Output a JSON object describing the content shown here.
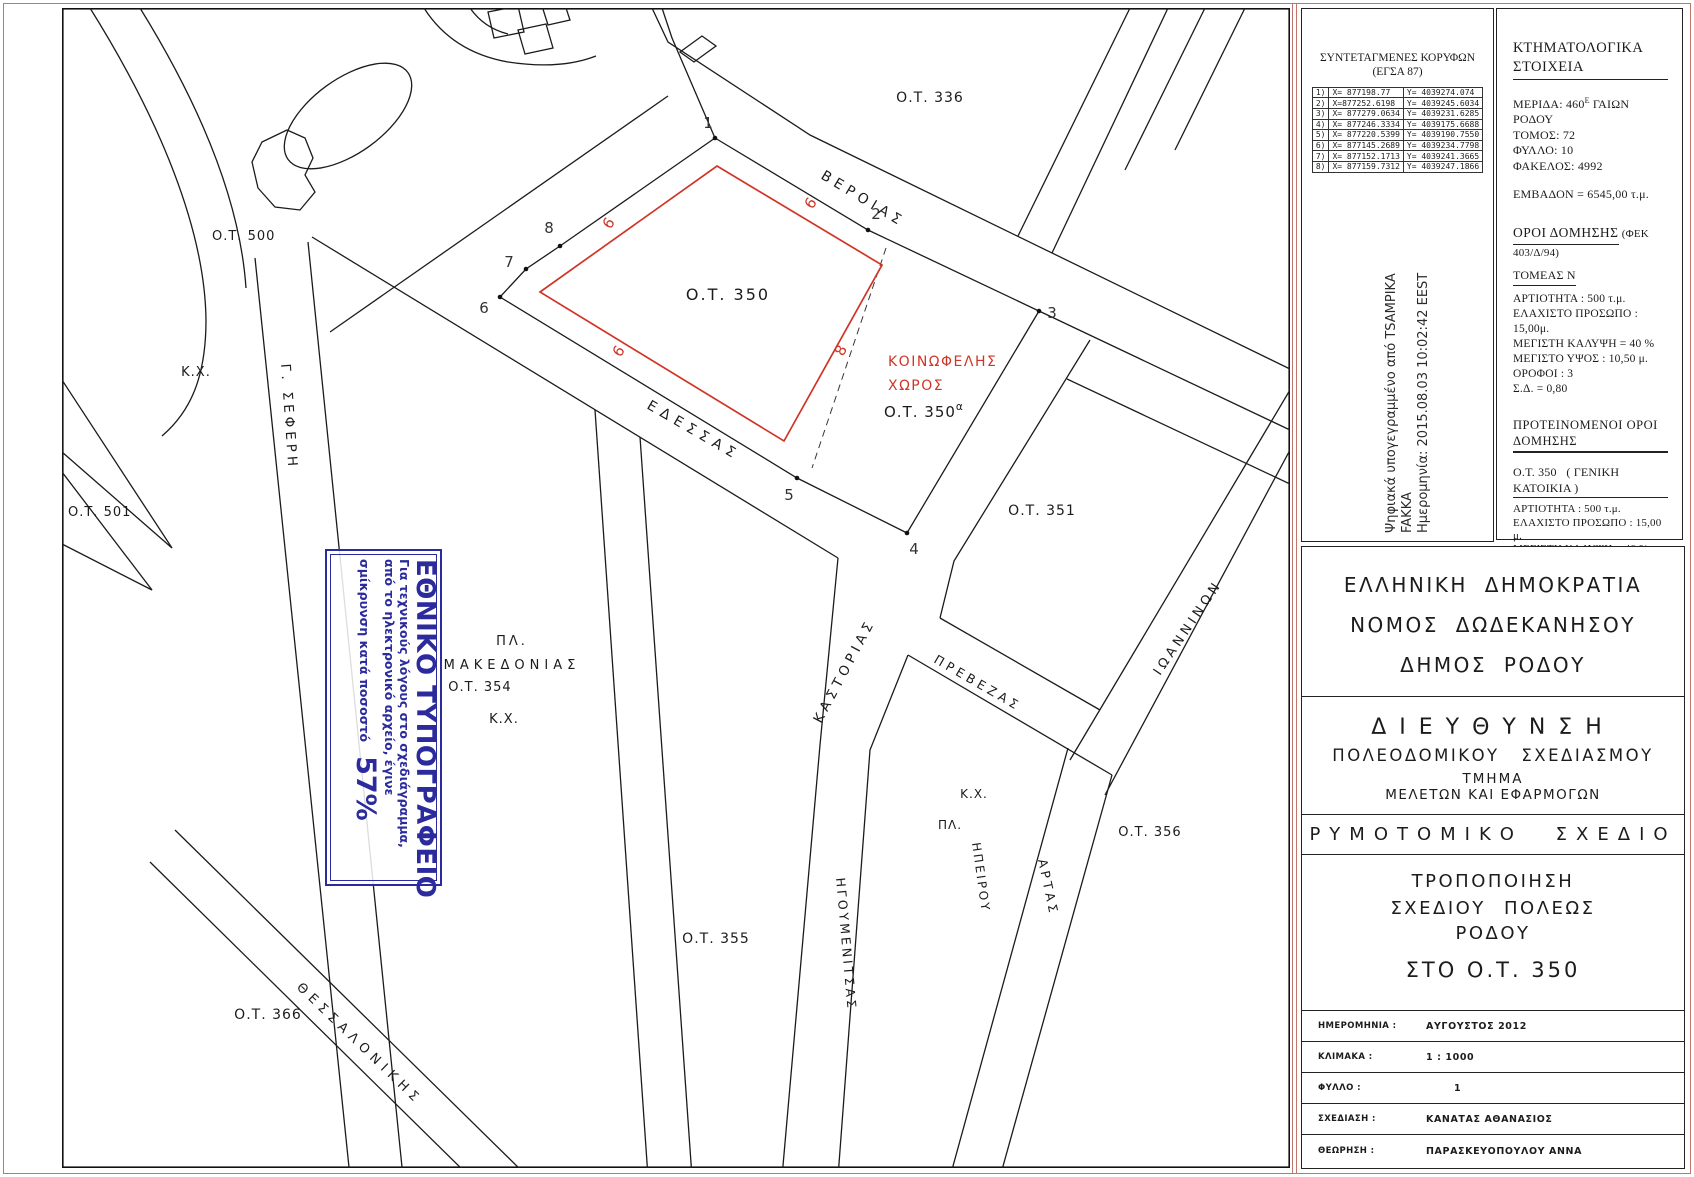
{
  "colors": {
    "accent_red": "#cf3526",
    "stamp_blue": "#2b2b9e",
    "frame_pink": "#c1766b",
    "line_black": "#1b1b1b"
  },
  "map": {
    "blocks": {
      "b336": "Ο.Τ. 336",
      "b350": "Ο.Τ.  350",
      "b350a_pre": "Ο.Τ.  350",
      "b350a_sup": "α",
      "b351": "Ο.Τ. 351",
      "b354": "Ο.Τ. 354",
      "b355": "Ο.Τ. 355",
      "b356": "Ο.Τ. 356",
      "b366": "Ο.Τ. 366",
      "b500": "Ο.Τ. 500",
      "b501": "Ο.Τ. 501"
    },
    "streets": {
      "verias": "ΒΕΡΟΙΑΣ",
      "edessas": "ΕΔΕΣΣΑΣ",
      "kastorias": "ΚΑΣΤΟΡΙΑΣ",
      "prevezas": "ΠΡΕΒΕΖΑΣ",
      "igoumenitsas": "ΗΓΟΥΜΕΝΙΤΣΑΣ",
      "ioanninon": "ΙΩΑΝΝΙΝΩΝ",
      "artas": "ΑΡΤΑΣ",
      "thessalonikis": "ΘΕΣΣΑΛΟΝΙΚΗΣ",
      "seferi": "Γ. ΣΕΦΕΡΗ"
    },
    "labels": {
      "kx_left": "Κ.Χ.",
      "pl_mak": "ΠΛ.",
      "makedonias": "ΜΑΚΕΔΟΝΙΑΣ",
      "kx_mak": "Κ.Χ.",
      "kx_plaza": "Κ.Χ.",
      "pl_plaza": "ΠΛ.",
      "ipeirou": "ΗΠΕΙΡΟΥ",
      "koinofelis1": "ΚΟΙΝΩΦΕΛΗΣ",
      "koinofelis2": "ΧΩΡΟΣ"
    },
    "vertices": [
      "1",
      "2",
      "3",
      "4",
      "5",
      "6",
      "7",
      "8"
    ],
    "red_dims": [
      "6",
      "6",
      "6",
      "8"
    ]
  },
  "coords_table": {
    "title1": "ΣΥΝΤΕΤΑΓΜΕΝΕΣ ΚΟΡΥΦΩΝ",
    "title2": "(ΕΓΣΑ 87)",
    "rows": [
      {
        "n": "1)",
        "x": "X= 877198.77",
        "y": "Y= 4039274.074"
      },
      {
        "n": "2)",
        "x": "X=877252.6198",
        "y": "Y= 4039245.6034"
      },
      {
        "n": "3)",
        "x": "X= 877279.0634",
        "y": "Y= 4039231.6285"
      },
      {
        "n": "4)",
        "x": "X= 877246.3334",
        "y": "Y= 4039175.6688"
      },
      {
        "n": "5)",
        "x": "X= 877220.5399",
        "y": "Y= 4039190.7550"
      },
      {
        "n": "6)",
        "x": "X= 877145.2689",
        "y": "Y= 4039234.7798"
      },
      {
        "n": "7)",
        "x": "X= 877152.1713",
        "y": "Y= 4039241.3665"
      },
      {
        "n": "8)",
        "x": "X= 877159.7312",
        "y": "Y= 4039247.1866"
      }
    ]
  },
  "signature": {
    "line1": "Ψηφιακά υπογεγραμμένο από TSAMPIKA",
    "line2": "FAKKA",
    "line3": "Ημερομηνία: 2015.08.03 10:02:42 EEST"
  },
  "cadastral": {
    "title": "ΚΤΗΜΑΤΟΛΟΓΙΚΑ ΣΤΟΙΧΕΙΑ",
    "merida_pre": "ΜΕΡΙΔΑ: 460",
    "merida_sup": "Ε",
    "merida_post": "ΓΑΙΩΝ ΡΟΔΟΥ",
    "tomos": "ΤΟΜΟΣ: 72",
    "fyllo": "ΦΥΛΛΟ: 10",
    "fakelos": "ΦΑΚΕΛΟΣ: 4992",
    "emvadon": "ΕΜΒΑΔΟΝ = 6545,00 τ.μ."
  },
  "terms": {
    "title": "ΟΡΟΙ ΔΟΜΗΣΗΣ",
    "fek": "(ΦΕΚ 403/Δ/94)",
    "sector": "ΤΟΜΕΑΣ Ν",
    "items": [
      "ΑΡΤΙΟΤΗΤΑ : 500 τ.μ.",
      "ΕΛΑΧΙΣΤΟ ΠΡΟΣΩΠΟ : 15,00μ.",
      "ΜΕΓΙΣΤΗ ΚΑΛΥΨΗ = 40 %",
      "ΜΕΓΙΣΤΟ ΥΨΟΣ : 10,50 μ.",
      "ΟΡΟΦΟΙ : 3",
      "Σ.Δ. = 0,80"
    ]
  },
  "proposed": {
    "title": "ΠΡΟΤΕΙΝΟΜΕΝΟΙ ΟΡΟΙ ΔΟΜΗΣΗΣ",
    "s1_pre": "Ο.Τ. 350",
    "s1_post": "( ΓΕΝΙΚΗ ΚΑΤΟΙΚΙΑ )",
    "s1_items": [
      "ΑΡΤΙΟΤΗΤΑ : 500 τ.μ.",
      "ΕΛΑΧΙΣΤΟ ΠΡΟΣΩΠΟ : 15,00 μ.",
      "ΜΕΓΙΣΤΗ ΚΑΛΥΨΗ = 40 %",
      "ΜΕΓΙΣΤΟ ΥΨΟΣ : 10,50 μ.",
      "ΟΡΟΦΟΙ : 3",
      "Σ.Δ. = 0,60"
    ],
    "s2_pre": "Ο.Τ. 350",
    "s2_sup": "α",
    "s2_post": "( ΚΟΙΝΩΦΕΛΗΣ ΧΩΡΟΣ )",
    "s2_items": [
      "ΑΡΤΙΟΤΗΤΑ : 500 τ.μ.",
      "ΕΛΑΧΙΣΤΟ ΠΡΟΣΩΠΟ : 15,00μ.",
      "ΜΕΓΙΣΤΗ ΚΑΛΥΨΗ = 60 %",
      "ΜΕΓΙΣΤΟ ΥΨΟΣ : 10,50 μ.",
      "ΟΡΟΦΟΙ : 3",
      "Σ.Δ. = 1,25"
    ]
  },
  "title_block": {
    "l1": "ΕΛΛΗΝΙΚΗ ΔΗΜΟΚΡΑΤΙΑ",
    "l2": "ΝΟΜΟΣ ΔΩΔΕΚΑΝΗΣΟΥ",
    "l3": "ΔΗΜΟΣ ΡΟΔΟΥ",
    "dept": "ΔΙΕΥΘΥΝΣΗ",
    "dept2": "ΠΟΛΕΟΔΟΜΙΚΟΥ ΣΧΕΔΙΑΣΜΟΥ",
    "tmima": "ΤΜΗΜΑ",
    "tmima2": "ΜΕΛΕΤΩΝ ΚΑΙ ΕΦΑΡΜΟΓΩΝ",
    "rymotomiko": "ΡΥΜΟΤΟΜΙΚΟ ΣΧΕΔΙΟ",
    "t1": "ΤΡΟΠΟΠΟΙΗΣΗ",
    "t2": "ΣΧΕΔΙΟΥ ΠΟΛΕΩΣ",
    "t3": "ΡΟΔΟΥ",
    "t4": "ΣΤΟ Ο.Τ. 350",
    "rows": [
      {
        "label": "ΗΜΕΡΟΜΗΝΙΑ :",
        "value": "ΑΥΓΟΥΣΤΟΣ 2012"
      },
      {
        "label": "ΚΛΙΜΑΚΑ :",
        "value": "1 : 1000"
      },
      {
        "label": "ΦΥΛΛΟ :",
        "value": "1"
      },
      {
        "label": "ΣΧΕΔΙΑΣΗ :",
        "value": "ΚΑΝΑΤΑΣ ΑΘΑΝΑΣΙΟΣ"
      },
      {
        "label": "ΘΕΩΡΗΣΗ :",
        "value": "ΠΑΡΑΣΚΕΥΟΠΟΥΛΟΥ ΑΝΝΑ"
      }
    ]
  },
  "stamp": {
    "line1": "ΕΘΝΙΚΟ ΤΥΠΟΓΡΑΦΕΙΟ",
    "line2": "Για τεχνικούς λόγους στο σχεδιάγραμμα,",
    "line3": "από το ηλεκτρονικό αρχείο, έγινε",
    "line4": "σμίκρυνση κατά ποσοστό",
    "pct": "57%"
  }
}
